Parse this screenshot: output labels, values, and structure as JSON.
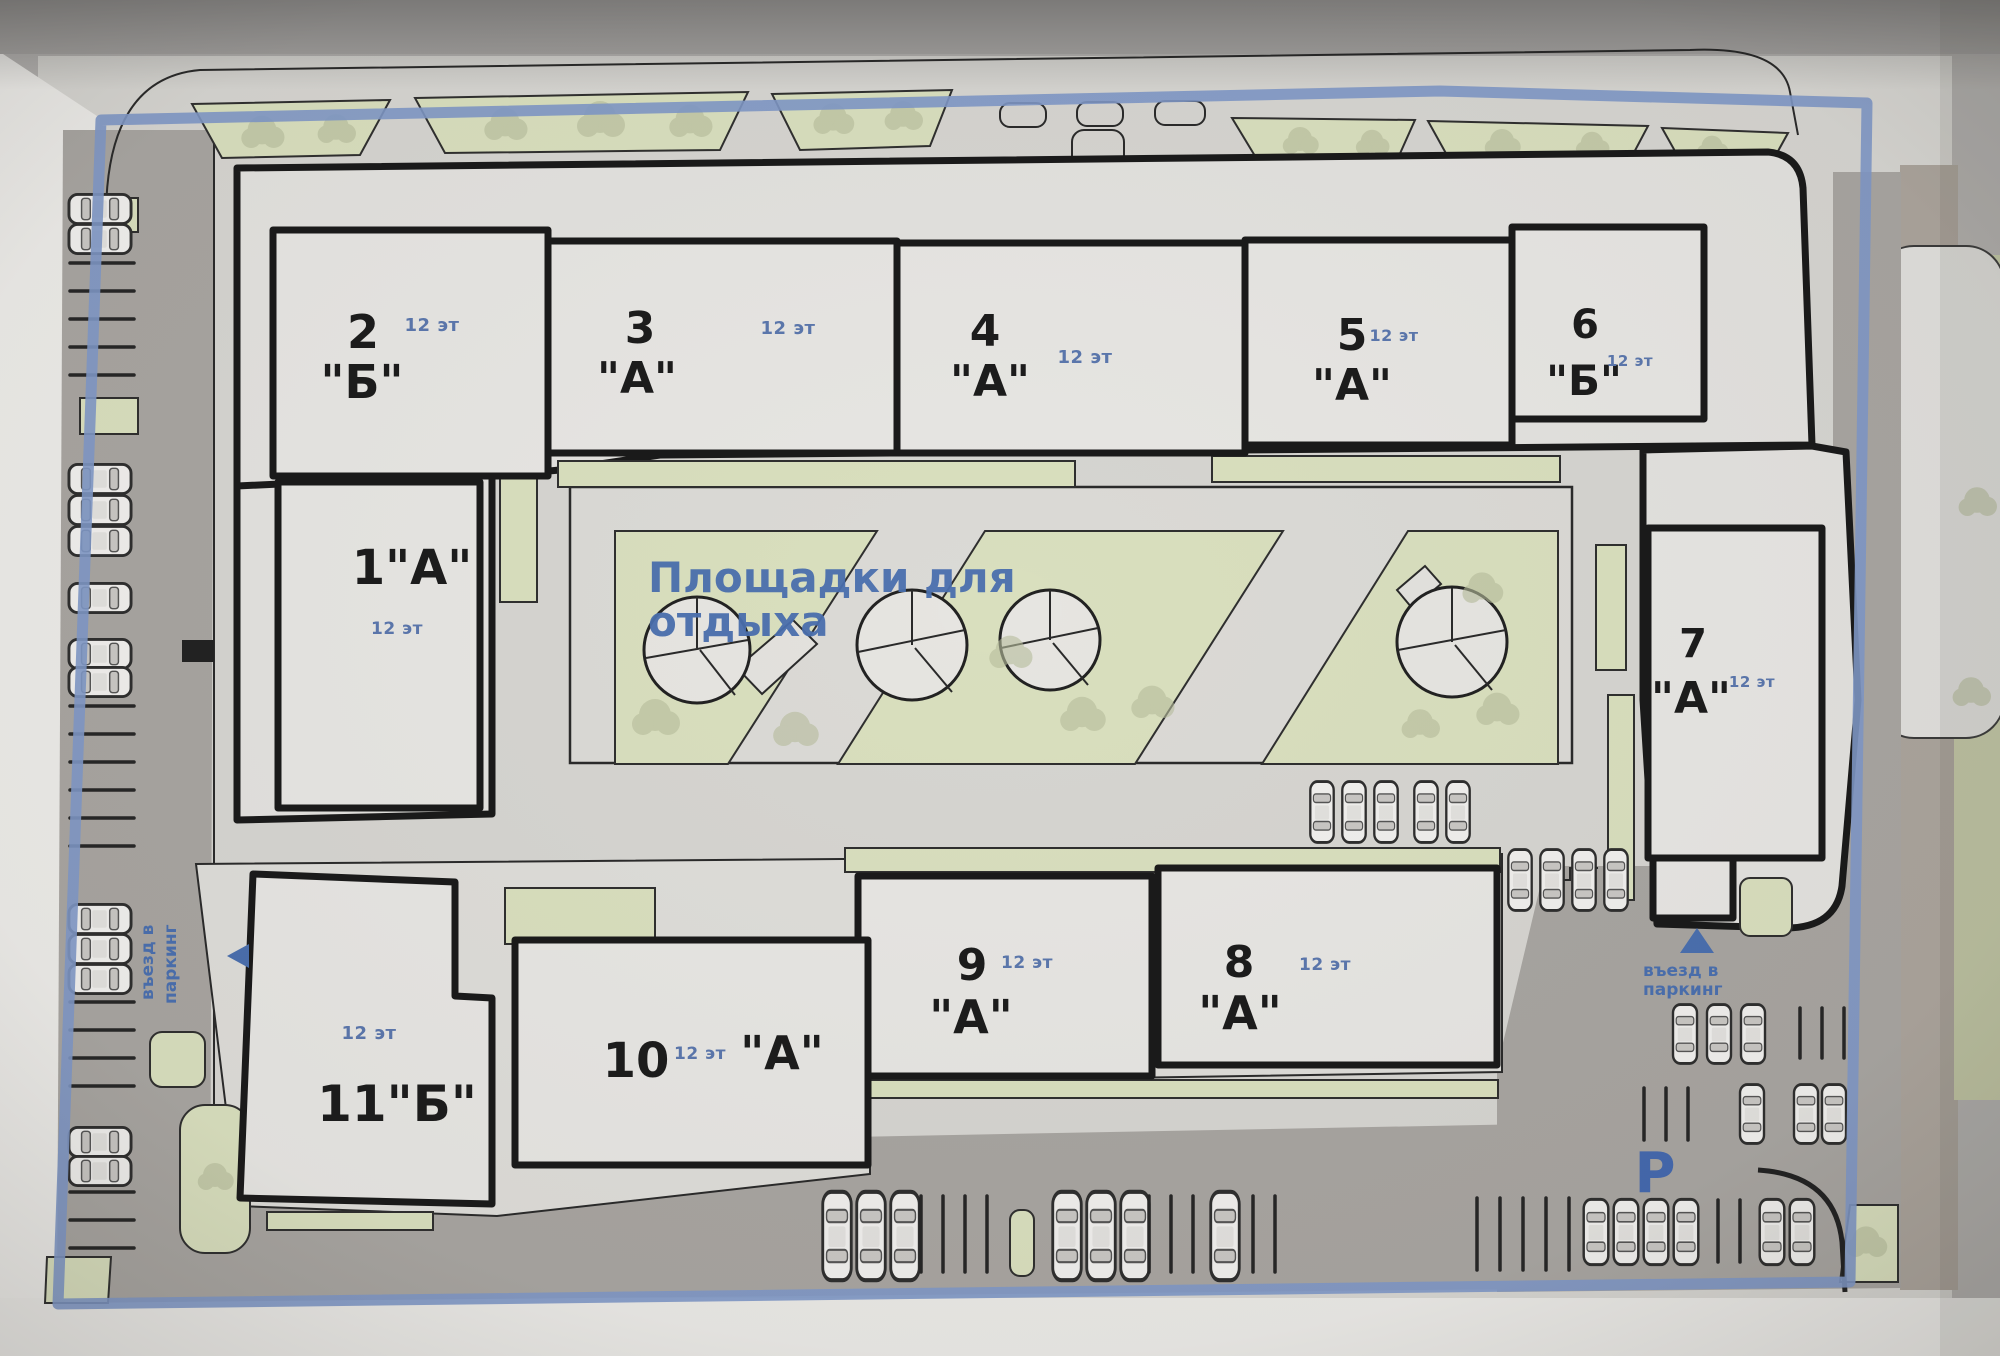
{
  "plan": {
    "type": "residential-complex-site-plan",
    "courtyard": {
      "label": "Площадки для отдыха",
      "lines": [
        "Площадки для",
        "отдыха"
      ]
    },
    "parking": {
      "entrance_left": {
        "line1": "въезд в",
        "line2": "паркинг"
      },
      "entrance_right": {
        "line1": "въезд в",
        "line2": "паркинг"
      },
      "symbol": "Р"
    }
  },
  "buildings": [
    {
      "num": "1\"А\"",
      "floors": "12 эт"
    },
    {
      "num": "2",
      "letter": "\"Б\"",
      "floors": "12 эт"
    },
    {
      "num": "3",
      "letter": "\"А\"",
      "floors": "12 эт"
    },
    {
      "num": "4",
      "letter": "\"А\"",
      "floors": "12 эт"
    },
    {
      "num": "5",
      "letter": "\"А\"",
      "floors": "12 эт"
    },
    {
      "num": "6",
      "letter": "\"Б\"",
      "floors": "12 эт"
    },
    {
      "num": "7",
      "letter": "\"А\"",
      "floors": "12 эт"
    },
    {
      "num": "8",
      "letter": "\"А\"",
      "floors": "12 эт"
    },
    {
      "num": "9",
      "letter": "\"А\"",
      "floors": "12 эт"
    },
    {
      "num": "10",
      "letter": "\"А\"",
      "floors": "12 эт"
    },
    {
      "num": "11\"Б\"",
      "floors": "12 эт"
    }
  ],
  "colors": {
    "boundary_blue": "#7f98c6",
    "label_blue": "#4a6fae",
    "floors_blue": "#5b77ad",
    "landscape_green": "#d9dfbe",
    "road_gray": "#a8a5a1",
    "paper": "#d6d5d1",
    "building_fill": "#e7e6e3",
    "outline": "#1a1a1a"
  }
}
